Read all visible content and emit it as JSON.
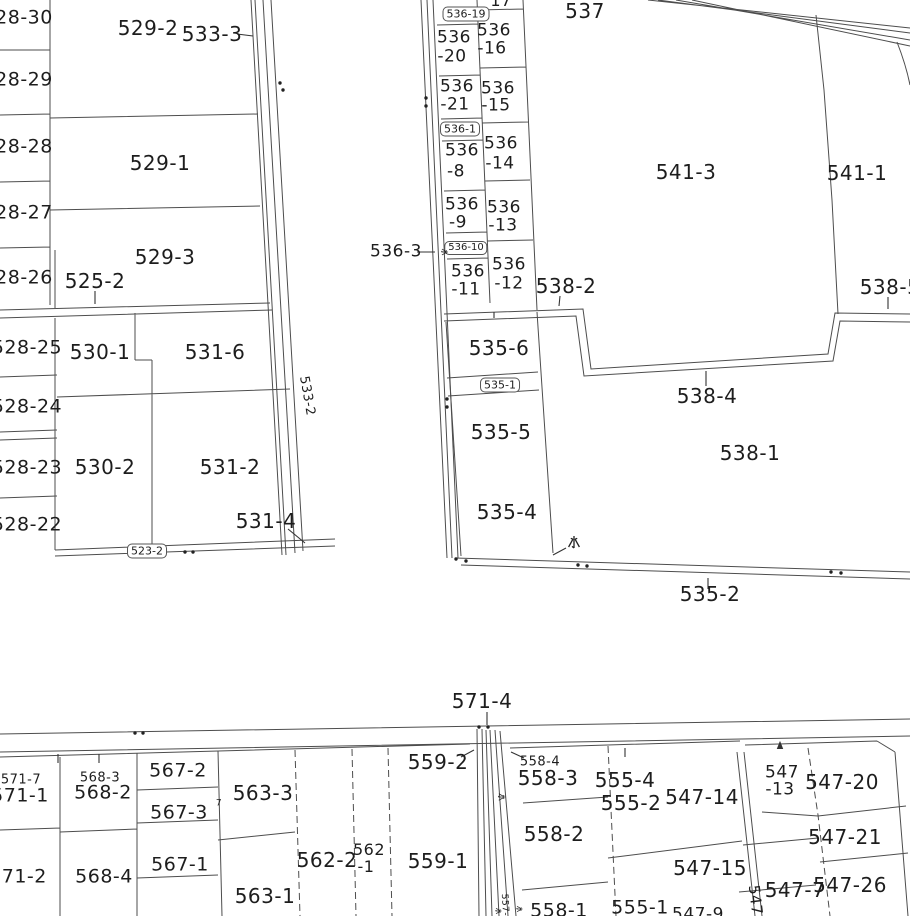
{
  "map": {
    "type": "cadastral-parcel-map",
    "highlighted_parcel": "535-4",
    "highlight_color": "#e60012",
    "water_char": "水",
    "labels": [
      {
        "t": "28-30",
        "x": 24,
        "y": 18,
        "fs": 19
      },
      {
        "t": "28-29",
        "x": 24,
        "y": 80,
        "fs": 19
      },
      {
        "t": "28-28",
        "x": 24,
        "y": 147,
        "fs": 19
      },
      {
        "t": "28-27",
        "x": 24,
        "y": 213,
        "fs": 19
      },
      {
        "t": "28-26",
        "x": 24,
        "y": 278,
        "fs": 19
      },
      {
        "t": "528-25",
        "x": 27,
        "y": 348,
        "fs": 19
      },
      {
        "t": "528-24",
        "x": 27,
        "y": 407,
        "fs": 19
      },
      {
        "t": "528-23",
        "x": 27,
        "y": 468,
        "fs": 19
      },
      {
        "t": "528-22",
        "x": 27,
        "y": 525,
        "fs": 19
      },
      {
        "t": "529-2",
        "x": 148,
        "y": 28,
        "fs": 20
      },
      {
        "t": "533-3",
        "x": 212,
        "y": 34,
        "fs": 20
      },
      {
        "t": "529-1",
        "x": 160,
        "y": 163,
        "fs": 20
      },
      {
        "t": "529-3",
        "x": 165,
        "y": 257,
        "fs": 20
      },
      {
        "t": "525-2",
        "x": 95,
        "y": 281,
        "fs": 20
      },
      {
        "t": "530-1",
        "x": 100,
        "y": 352,
        "fs": 20
      },
      {
        "t": "531-6",
        "x": 215,
        "y": 352,
        "fs": 20
      },
      {
        "t": "533-2",
        "x": 307,
        "y": 396,
        "fs": 13,
        "rot": 80
      },
      {
        "t": "530-2",
        "x": 105,
        "y": 467,
        "fs": 20
      },
      {
        "t": "531-2",
        "x": 230,
        "y": 467,
        "fs": 20
      },
      {
        "t": "531-4",
        "x": 266,
        "y": 521,
        "fs": 20
      },
      {
        "t": "523-2",
        "x": 147,
        "y": 551,
        "fs": 11,
        "box": true
      },
      {
        "t": "536-19",
        "x": 466,
        "y": 14,
        "fs": 11,
        "box": true
      },
      {
        "t": "17",
        "x": 501,
        "y": 1,
        "fs": 16
      },
      {
        "t": "536",
        "x": 454,
        "y": 38,
        "fs": 17
      },
      {
        "t": "-20",
        "x": 452,
        "y": 57,
        "fs": 17
      },
      {
        "t": "536",
        "x": 494,
        "y": 31,
        "fs": 17
      },
      {
        "t": "-16",
        "x": 492,
        "y": 49,
        "fs": 17
      },
      {
        "t": "536",
        "x": 457,
        "y": 87,
        "fs": 17
      },
      {
        "t": "-21",
        "x": 455,
        "y": 105,
        "fs": 17
      },
      {
        "t": "536",
        "x": 498,
        "y": 89,
        "fs": 17
      },
      {
        "t": "-15",
        "x": 496,
        "y": 106,
        "fs": 17
      },
      {
        "t": "536-1",
        "x": 460,
        "y": 129,
        "fs": 11,
        "box": true
      },
      {
        "t": "536",
        "x": 462,
        "y": 151,
        "fs": 17
      },
      {
        "t": "-8",
        "x": 456,
        "y": 172,
        "fs": 17
      },
      {
        "t": "536",
        "x": 501,
        "y": 144,
        "fs": 17
      },
      {
        "t": "-14",
        "x": 500,
        "y": 164,
        "fs": 17
      },
      {
        "t": "536",
        "x": 462,
        "y": 205,
        "fs": 17
      },
      {
        "t": "-9",
        "x": 458,
        "y": 223,
        "fs": 17
      },
      {
        "t": "536",
        "x": 504,
        "y": 208,
        "fs": 17
      },
      {
        "t": "-13",
        "x": 503,
        "y": 226,
        "fs": 17
      },
      {
        "t": "536-10",
        "x": 466,
        "y": 248,
        "fs": 10,
        "box": true
      },
      {
        "t": "536",
        "x": 468,
        "y": 272,
        "fs": 17
      },
      {
        "t": "-11",
        "x": 466,
        "y": 290,
        "fs": 17
      },
      {
        "t": "536",
        "x": 509,
        "y": 265,
        "fs": 17
      },
      {
        "t": "-12",
        "x": 509,
        "y": 284,
        "fs": 17
      },
      {
        "t": "536-3",
        "x": 396,
        "y": 252,
        "fs": 17
      },
      {
        "t": "537",
        "x": 585,
        "y": 11,
        "fs": 20
      },
      {
        "t": "541-3",
        "x": 686,
        "y": 172,
        "fs": 20
      },
      {
        "t": "541-1",
        "x": 857,
        "y": 173,
        "fs": 20
      },
      {
        "t": "538-5",
        "x": 890,
        "y": 287,
        "fs": 20
      },
      {
        "t": "538-2",
        "x": 566,
        "y": 286,
        "fs": 20
      },
      {
        "t": "538-4",
        "x": 707,
        "y": 396,
        "fs": 20
      },
      {
        "t": "538-1",
        "x": 750,
        "y": 453,
        "fs": 20
      },
      {
        "t": "535-6",
        "x": 499,
        "y": 348,
        "fs": 20
      },
      {
        "t": "535-1",
        "x": 500,
        "y": 385,
        "fs": 11,
        "box": true
      },
      {
        "t": "535-5",
        "x": 501,
        "y": 432,
        "fs": 20
      },
      {
        "t": "535-4",
        "x": 507,
        "y": 512,
        "fs": 20
      },
      {
        "t": "535-2",
        "x": 710,
        "y": 594,
        "fs": 20
      },
      {
        "t": "571-4",
        "x": 482,
        "y": 701,
        "fs": 20
      },
      {
        "t": "559-2",
        "x": 438,
        "y": 762,
        "fs": 20
      },
      {
        "t": "558-4",
        "x": 540,
        "y": 762,
        "fs": 13
      },
      {
        "t": "558-3",
        "x": 548,
        "y": 778,
        "fs": 20
      },
      {
        "t": "555-4",
        "x": 625,
        "y": 780,
        "fs": 20
      },
      {
        "t": "555-2",
        "x": 631,
        "y": 803,
        "fs": 20
      },
      {
        "t": "558-2",
        "x": 554,
        "y": 834,
        "fs": 20
      },
      {
        "t": "559-1",
        "x": 438,
        "y": 861,
        "fs": 20
      },
      {
        "t": "562-2",
        "x": 327,
        "y": 860,
        "fs": 20
      },
      {
        "t": "562",
        "x": 369,
        "y": 850,
        "fs": 16
      },
      {
        "t": "-1",
        "x": 366,
        "y": 867,
        "fs": 16
      },
      {
        "t": "558-1",
        "x": 559,
        "y": 911,
        "fs": 19
      },
      {
        "t": "555-1",
        "x": 640,
        "y": 908,
        "fs": 19
      },
      {
        "t": "547-14",
        "x": 702,
        "y": 797,
        "fs": 20
      },
      {
        "t": "547",
        "x": 782,
        "y": 773,
        "fs": 17
      },
      {
        "t": "-13",
        "x": 780,
        "y": 790,
        "fs": 17
      },
      {
        "t": "547-20",
        "x": 842,
        "y": 782,
        "fs": 20
      },
      {
        "t": "547-21",
        "x": 845,
        "y": 837,
        "fs": 20
      },
      {
        "t": "547-26",
        "x": 850,
        "y": 885,
        "fs": 20
      },
      {
        "t": "547-7",
        "x": 795,
        "y": 890,
        "fs": 20
      },
      {
        "t": "547-15",
        "x": 710,
        "y": 868,
        "fs": 20
      },
      {
        "t": "547",
        "x": 755,
        "y": 900,
        "fs": 15,
        "rot": 83
      },
      {
        "t": "547-9",
        "x": 698,
        "y": 915,
        "fs": 17
      },
      {
        "t": "557-",
        "x": 504,
        "y": 905,
        "fs": 9,
        "rot": 87
      },
      {
        "t": "571-7",
        "x": 21,
        "y": 780,
        "fs": 13
      },
      {
        "t": "571-1",
        "x": 20,
        "y": 796,
        "fs": 19
      },
      {
        "t": "568-3",
        "x": 100,
        "y": 778,
        "fs": 13
      },
      {
        "t": "568-2",
        "x": 103,
        "y": 793,
        "fs": 19
      },
      {
        "t": "567-2",
        "x": 178,
        "y": 771,
        "fs": 19
      },
      {
        "t": "567-3",
        "x": 179,
        "y": 813,
        "fs": 19
      },
      {
        "t": "567-1",
        "x": 180,
        "y": 865,
        "fs": 19
      },
      {
        "t": "563-3",
        "x": 263,
        "y": 793,
        "fs": 20
      },
      {
        "t": "563-1",
        "x": 265,
        "y": 896,
        "fs": 20
      },
      {
        "t": "571-2",
        "x": 18,
        "y": 877,
        "fs": 19
      },
      {
        "t": "568-4",
        "x": 104,
        "y": 877,
        "fs": 19
      },
      {
        "t": "7",
        "x": 219,
        "y": 804,
        "fs": 9
      }
    ],
    "water_marks": [
      {
        "x": 574,
        "y": 545,
        "s": 1,
        "rot": 0
      },
      {
        "x": 443,
        "y": 252,
        "s": 0.55,
        "rot": 90
      },
      {
        "x": 500,
        "y": 797,
        "s": 0.6,
        "rot": 90
      },
      {
        "x": 497,
        "y": 911,
        "s": 0.5,
        "rot": 90
      },
      {
        "x": 518,
        "y": 909,
        "s": 0.5,
        "rot": 90
      }
    ]
  }
}
